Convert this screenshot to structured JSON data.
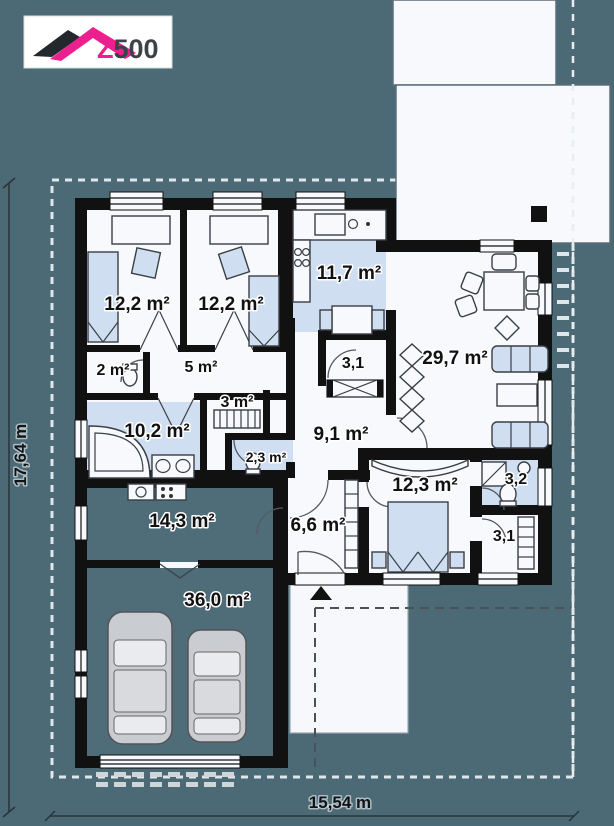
{
  "colors": {
    "background": "#4b6a75",
    "plan_white": "#f7f9fc",
    "floor_blue": "#cfdff1",
    "teal_floor": "#4e6d78",
    "wall_black": "#111111",
    "accent_pink": "#ec1f8e",
    "car_gray": "#c9ccd0",
    "label_text": "#111111"
  },
  "logo": {
    "z": "Z",
    "numbers": "500"
  },
  "rooms": {
    "bedroom_1": {
      "area": "12,2 m²"
    },
    "bedroom_2": {
      "area": "12,2 m²"
    },
    "kitchen": {
      "area": "11,7 m²"
    },
    "pantry": {
      "area": "3,1"
    },
    "living_room": {
      "area": "29,7 m²"
    },
    "wc_small": {
      "area": "2 m²"
    },
    "hall": {
      "area": "5 m²"
    },
    "wardrobe_small": {
      "area": "3 m²"
    },
    "bathroom": {
      "area": "10,2 m²"
    },
    "wc": {
      "area": "2,3 m²"
    },
    "corridor": {
      "area": "9,1 m²"
    },
    "bedroom_3": {
      "area": "12,3 m²"
    },
    "bathroom_2": {
      "area": "3,2"
    },
    "wardrobe_2": {
      "area": "3,1"
    },
    "utility": {
      "area": "14,3 m²"
    },
    "entrance_hall": {
      "area": "6,6 m²"
    },
    "garage": {
      "area": "36,0 m²"
    }
  },
  "dimensions": {
    "width": "15,54 m",
    "height": "17,64 m"
  }
}
